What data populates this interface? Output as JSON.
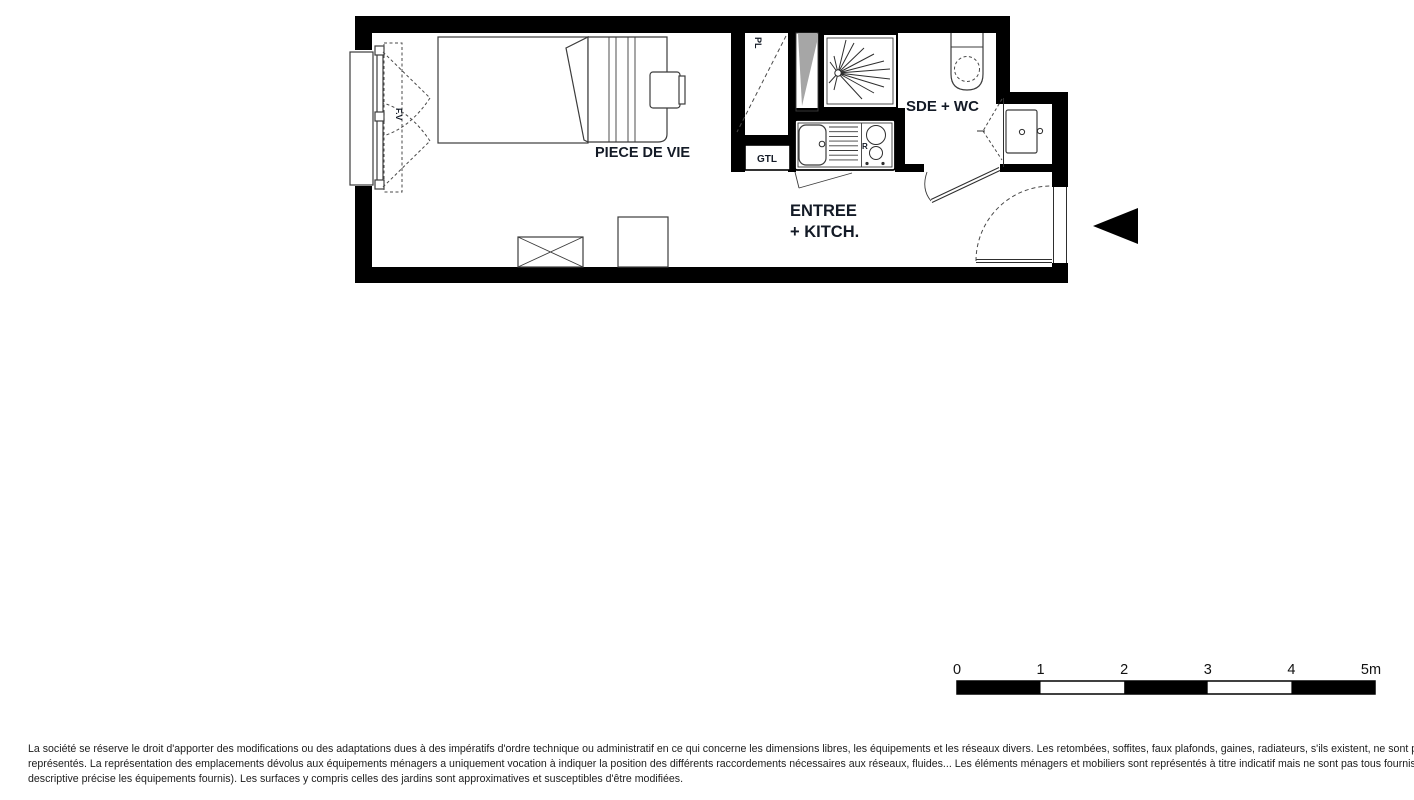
{
  "floorplan": {
    "labels": {
      "living": "PIECE DE VIE",
      "entry_line1": "ENTREE",
      "entry_line2": "+ KITCH.",
      "bathroom": "SDE + WC",
      "closet": "PL",
      "gtl": "GTL",
      "window": "F.V",
      "hob": "R"
    },
    "scale_bar": {
      "ticks": [
        "0",
        "1",
        "2",
        "3",
        "4",
        "5m"
      ]
    },
    "colors": {
      "wall": "#000000",
      "label_text": "#131a26",
      "duct_shade": "#a6a6a6",
      "furniture_line": "#3c3c3c"
    }
  },
  "disclaimer": {
    "line1": "La société se réserve le droit d'apporter des modifications ou des adaptations dues à des impératifs d'ordre technique ou administratif en ce qui concerne les dimensions libres, les équipements et les réseaux divers. Les retombées, soffites, faux plafonds, gaines, radiateurs, s'ils existent, ne sont pas tous",
    "line2": "représentés. La représentation des emplacements dévolus aux équipements ménagers a uniquement vocation à indiquer la position des différents raccordements nécessaires aux réseaux, fluides... Les éléments ménagers et mobiliers sont représentés à titre indicatif mais ne sont pas tous fournis (seule la notice",
    "line3": "descriptive précise les équipements fournis). Les surfaces y compris celles des jardins sont approximatives et susceptibles d'être modifiées."
  }
}
